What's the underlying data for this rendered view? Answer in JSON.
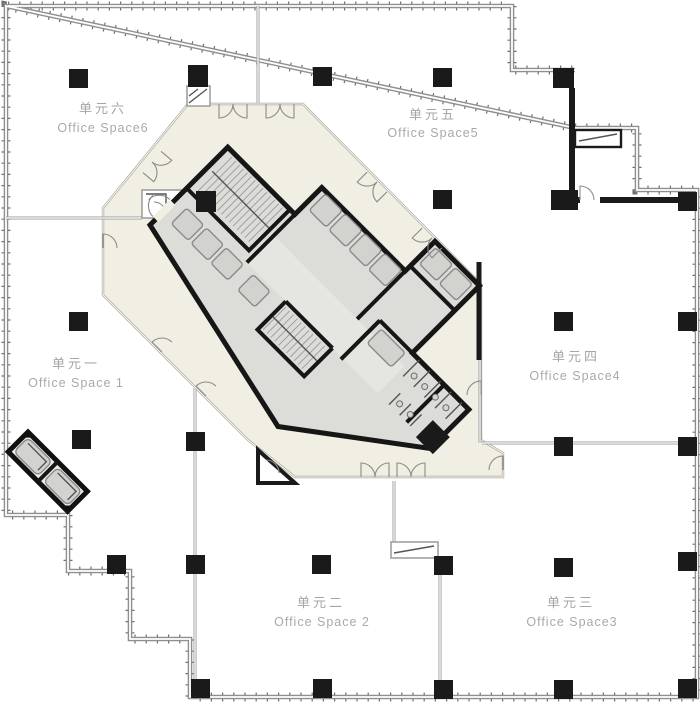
{
  "plan": {
    "type": "architectural-floor-plan",
    "units": [
      {
        "id": "unit-1",
        "zh": "单元一",
        "en": "Office Space 1"
      },
      {
        "id": "unit-2",
        "zh": "单元二",
        "en": "Office Space 2"
      },
      {
        "id": "unit-3",
        "zh": "单元三",
        "en": "Office Space3"
      },
      {
        "id": "unit-4",
        "zh": "单元四",
        "en": "Office Space4"
      },
      {
        "id": "unit-5",
        "zh": "单元五",
        "en": "Office Space5"
      },
      {
        "id": "unit-6",
        "zh": "单元六",
        "en": "Office Space6"
      }
    ],
    "core": {
      "contents": [
        "elevators",
        "stairs",
        "restrooms",
        "corridor"
      ],
      "orientation_degrees": 45
    },
    "colors": {
      "outer_wall": "#8f8f8f",
      "core_wall": "#1a1a1a",
      "corridor_ring": "#f1efe4",
      "core_fill": "#dcdcd8",
      "column": "#1a1a1a",
      "label_text": "#a5a5a5",
      "background": "#ffffff"
    }
  }
}
